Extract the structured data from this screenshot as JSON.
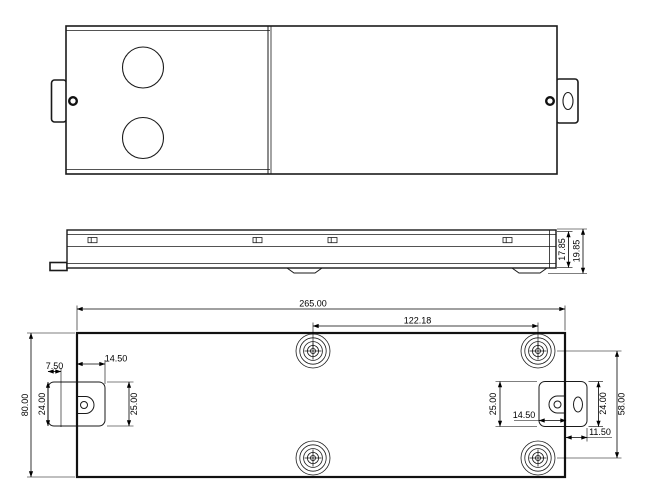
{
  "drawing_title": "enclosure-three-view-drawing",
  "colors": {
    "line": "#1a1a1a",
    "background": "#ffffff"
  },
  "views": {
    "side_view": {
      "dims": {
        "body_height": "17.85",
        "overall_height": "19.85"
      }
    },
    "bottom_view": {
      "dims": {
        "overall_length": "265.00",
        "foot_spacing_x": "122.18",
        "overall_width": "80.00",
        "foot_spacing_y": "58.00",
        "left_ear_offset": "7.50",
        "left_ear_depth": "14.50",
        "left_ear_outer_height": "24.00",
        "left_ear_inner_height": "25.00",
        "right_ear_inner_height": "25.00",
        "right_ear_depth": "14.50",
        "right_ear_outer_height": "24.00",
        "right_slot_offset": "11.50"
      }
    }
  }
}
